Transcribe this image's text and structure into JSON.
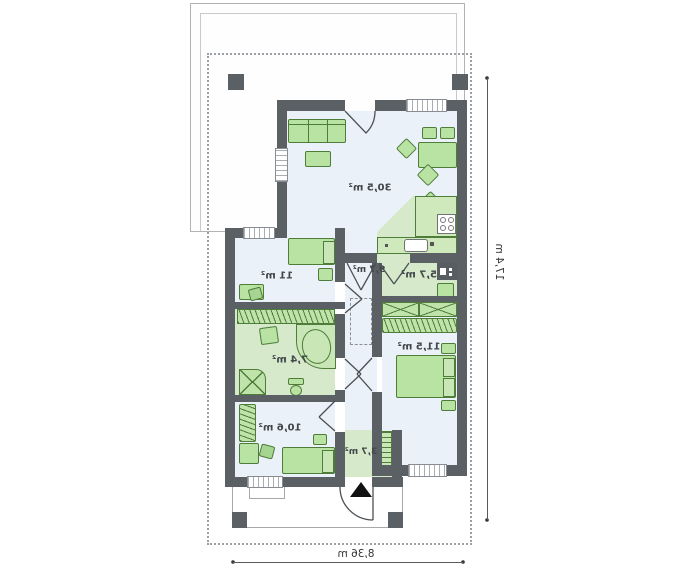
{
  "plan": {
    "rooms": [
      {
        "id": "living-room-kitchen",
        "area_label": "30,5 m²"
      },
      {
        "id": "hallway",
        "area_label": "9,7 m²"
      },
      {
        "id": "pantry",
        "area_label": "5,7 m²"
      },
      {
        "id": "bedroom-left",
        "area_label": "11 m²"
      },
      {
        "id": "bathroom",
        "area_label": "7,4 m²"
      },
      {
        "id": "bedroom-right",
        "area_label": "11,5 m²"
      },
      {
        "id": "bedroom-bottom",
        "area_label": "10,6 m²"
      },
      {
        "id": "entrance-hall",
        "area_label": "3,7 m²"
      }
    ],
    "dimensions": {
      "vertical": "17,4 m",
      "horizontal": "8,36 m"
    },
    "colors": {
      "wall": "#5b6064",
      "furniture_fill": "#b8e3a3",
      "furniture_stroke": "#4e7d39",
      "floor_light": "#ebf1f8",
      "floor_green": "#d7e9cb",
      "counter": "#cfe9bd"
    }
  }
}
